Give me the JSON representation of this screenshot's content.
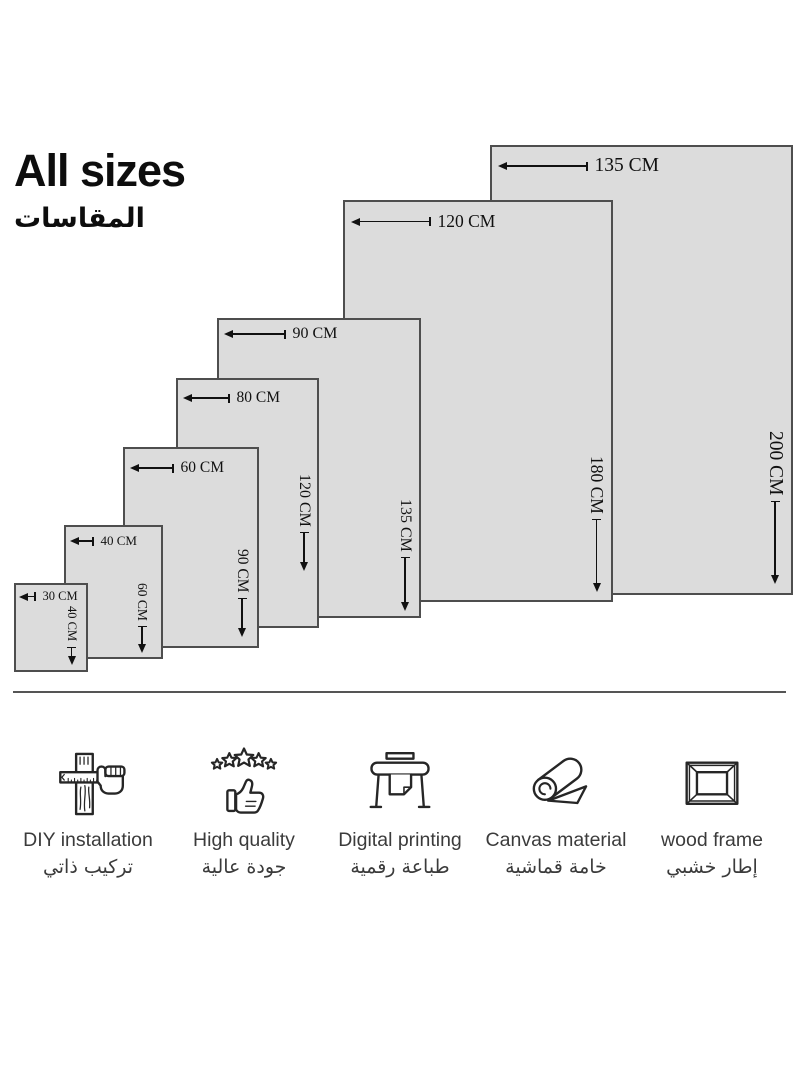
{
  "title": {
    "en": "All sizes",
    "ar": "المقاسات"
  },
  "size_chart": {
    "unit": "CM",
    "sizes": [
      {
        "width_cm": 30,
        "height_cm": 40,
        "width_label": "30 CM",
        "height_label": "40 CM"
      },
      {
        "width_cm": 40,
        "height_cm": 60,
        "width_label": "40 CM",
        "height_label": "60 CM"
      },
      {
        "width_cm": 60,
        "height_cm": 90,
        "width_label": "60 CM",
        "height_label": "90 CM"
      },
      {
        "width_cm": 80,
        "height_cm": 120,
        "width_label": "80 CM",
        "height_label": "120 CM"
      },
      {
        "width_cm": 90,
        "height_cm": 135,
        "width_label": "90 CM",
        "height_label": "135 CM"
      },
      {
        "width_cm": 120,
        "height_cm": 180,
        "width_label": "120 CM",
        "height_label": "180 CM"
      },
      {
        "width_cm": 135,
        "height_cm": 200,
        "width_label": "135 CM",
        "height_label": "200 CM"
      }
    ]
  },
  "features": [
    {
      "icon": "diy-installation-icon",
      "label_en": "DIY installation",
      "label_ar": "تركيب ذاتي"
    },
    {
      "icon": "high-quality-icon",
      "label_en": "High quality",
      "label_ar": "جودة عالية"
    },
    {
      "icon": "digital-printing-icon",
      "label_en": "Digital printing",
      "label_ar": "طباعة رقمية"
    },
    {
      "icon": "canvas-material-icon",
      "label_en": "Canvas material",
      "label_ar": "خامة قماشية"
    },
    {
      "icon": "wood-frame-icon",
      "label_en": "wood frame",
      "label_ar": "إطار خشبي"
    }
  ],
  "colors": {
    "background": "#ffffff",
    "rect_fill": "#dcdcdc",
    "rect_border": "#4e4e4e",
    "dimension_text": "#111111",
    "title_text": "#0d0d0d",
    "caption_text": "#3b3b3b",
    "divider": "#555555"
  }
}
